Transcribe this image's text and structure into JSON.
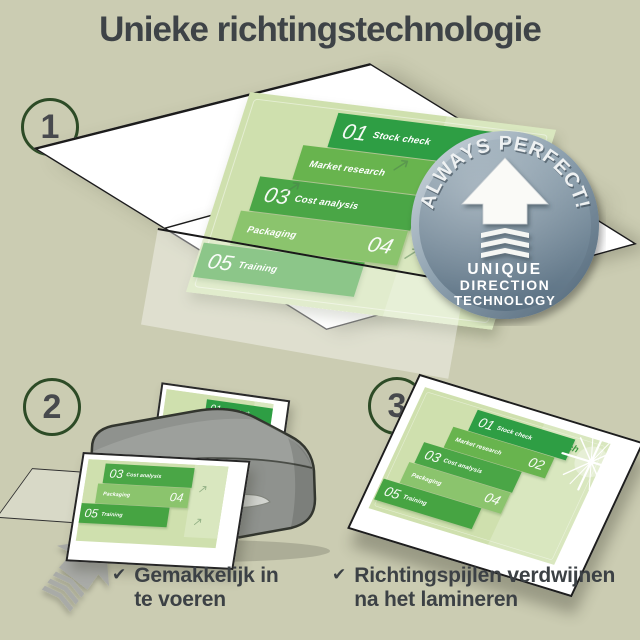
{
  "title": "Unieke richtingstechnologie",
  "step_numbers": [
    "1",
    "2",
    "3"
  ],
  "badge": {
    "arc_text": "ALWAYS PERFECT!",
    "line1": "UNIQUE",
    "line2": "DIRECTION",
    "line3": "TECHNOLOGY"
  },
  "doc": {
    "launch_label": "Launch",
    "items": [
      {
        "num": "01",
        "label": "Stock check"
      },
      {
        "num": "02",
        "label": "Market research"
      },
      {
        "num": "03",
        "label": "Cost analysis"
      },
      {
        "num": "04",
        "label": "Packaging"
      },
      {
        "num": "05",
        "label": "Training"
      }
    ]
  },
  "checklist": {
    "check_glyph": "✔",
    "items": [
      {
        "line1": "Gemakkelijk in",
        "line2": "te voeren"
      },
      {
        "line1": "Richtingspijlen verdwijnen",
        "line2": "na het lamineren"
      }
    ]
  },
  "colors": {
    "background": "#cbccb2",
    "heading_text": "#3e4347",
    "step_circle_ring": "#2d4b26",
    "doc_background": "#cfe0ae",
    "doc_block_01": "#2e9e44",
    "doc_block_02": "#68b44e",
    "doc_block_03": "#4aa646",
    "doc_block_04": "#8bc46d",
    "doc_block_05": "#46a442",
    "launch_green": "#3e9b41",
    "badge_blue_gray": "#667c8d",
    "laminator_gray": "#8f928e",
    "arrow_gray": "#a9aba7"
  }
}
